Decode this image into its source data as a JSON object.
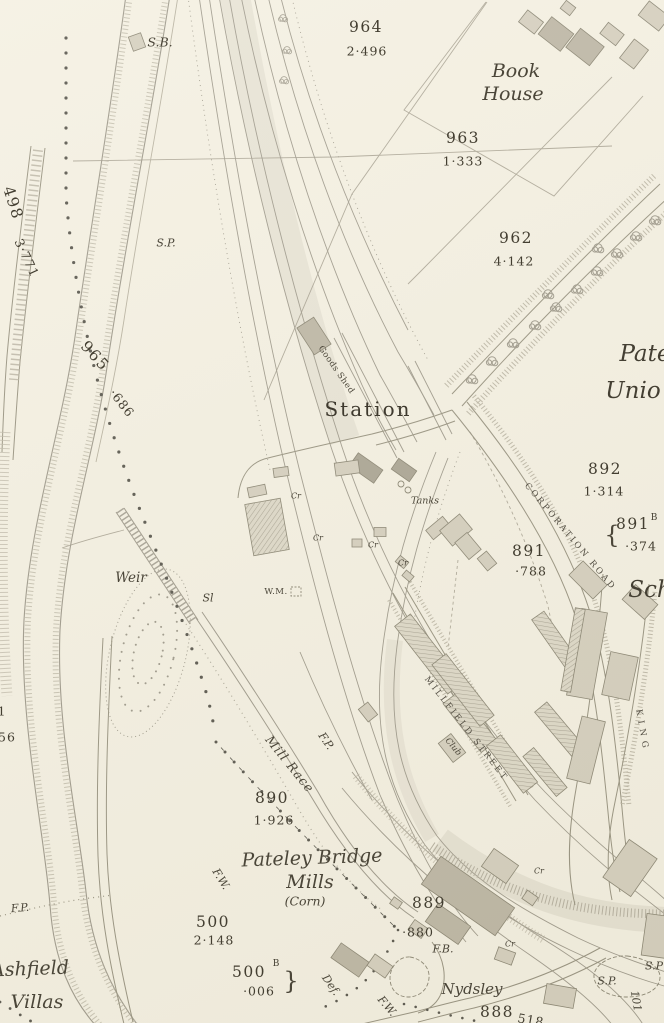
{
  "map": {
    "kind": "historical-survey-map",
    "labels": [
      {
        "n": "signal-box",
        "t": "S.B.",
        "x": 160,
        "y": 42,
        "r": 0,
        "c": "feat13"
      },
      {
        "n": "parcel-964",
        "t": "964",
        "x": 366,
        "y": 27,
        "r": 0,
        "c": "parcel"
      },
      {
        "n": "area-964",
        "t": "2·496",
        "x": 367,
        "y": 51,
        "r": 0,
        "c": "acre"
      },
      {
        "n": "book-house-line1",
        "t": "Book",
        "x": 516,
        "y": 71,
        "r": 0,
        "c": "place"
      },
      {
        "n": "book-house-line2",
        "t": "House",
        "x": 513,
        "y": 94,
        "r": 0,
        "c": "place"
      },
      {
        "n": "parcel-963",
        "t": "963",
        "x": 463,
        "y": 138,
        "r": 0,
        "c": "parcel"
      },
      {
        "n": "area-963",
        "t": "1·333",
        "x": 463,
        "y": 161,
        "r": 0,
        "c": "acre"
      },
      {
        "n": "parcel-962",
        "t": "962",
        "x": 516,
        "y": 238,
        "r": 0,
        "c": "parcel"
      },
      {
        "n": "area-962",
        "t": "4·142",
        "x": 514,
        "y": 261,
        "r": 0,
        "c": "acre"
      },
      {
        "n": "parcel-498",
        "t": "498",
        "x": 13,
        "y": 203,
        "r": 72,
        "c": "parcel"
      },
      {
        "n": "area-498",
        "t": "3·771",
        "x": 27,
        "y": 258,
        "r": 65,
        "c": "acre"
      },
      {
        "n": "signal-post-north",
        "t": "S.P.",
        "x": 166,
        "y": 243,
        "r": 0,
        "c": "feat"
      },
      {
        "n": "parcel-965",
        "t": "965",
        "x": 95,
        "y": 356,
        "r": 48,
        "c": "parcel"
      },
      {
        "n": "area-965",
        "t": "·686",
        "x": 122,
        "y": 403,
        "r": 52,
        "c": "acre"
      },
      {
        "n": "goods-shed",
        "t": "Goods Shed",
        "x": 336,
        "y": 370,
        "r": 55,
        "c": "tiny9"
      },
      {
        "n": "station",
        "t": "Station",
        "x": 368,
        "y": 409,
        "r": 0,
        "c": "station"
      },
      {
        "n": "pateley-union-line1",
        "t": "Pate",
        "x": 645,
        "y": 354,
        "r": 0,
        "c": "place-lg"
      },
      {
        "n": "pateley-union-line2",
        "t": "Unio",
        "x": 633,
        "y": 391,
        "r": 0,
        "c": "place-lg"
      },
      {
        "n": "parcel-892",
        "t": "892",
        "x": 605,
        "y": 469,
        "r": 0,
        "c": "parcel"
      },
      {
        "n": "area-892",
        "t": "1·314",
        "x": 604,
        "y": 491,
        "r": 0,
        "c": "acre"
      },
      {
        "n": "brace-891b",
        "t": "{",
        "x": 612,
        "y": 535,
        "r": 0,
        "c": "brace"
      },
      {
        "n": "parcel-891b",
        "t": "891",
        "x": 633,
        "y": 524,
        "r": 0,
        "c": "parcel"
      },
      {
        "n": "parcel-891b-sup",
        "t": "B",
        "x": 654,
        "y": 518,
        "r": 0,
        "c": "sup"
      },
      {
        "n": "area-891b",
        "t": "·374",
        "x": 641,
        "y": 546,
        "r": 0,
        "c": "acre"
      },
      {
        "n": "parcel-891",
        "t": "891",
        "x": 529,
        "y": 551,
        "r": 0,
        "c": "parcel"
      },
      {
        "n": "area-891",
        "t": "·788",
        "x": 531,
        "y": 571,
        "r": 0,
        "c": "acre"
      },
      {
        "n": "corporation-road",
        "t": "CORPORATION ROAD",
        "x": 570,
        "y": 537,
        "r": 50,
        "c": "road"
      },
      {
        "n": "weir",
        "t": "Weir",
        "x": 131,
        "y": 578,
        "r": 0,
        "c": "feat14"
      },
      {
        "n": "sluice",
        "t": "Sl",
        "x": 208,
        "y": 598,
        "r": 0,
        "c": "feat"
      },
      {
        "n": "weighing-machine",
        "t": "W.M.",
        "x": 276,
        "y": 592,
        "r": 0,
        "c": "tiny9"
      },
      {
        "n": "tanks",
        "t": "Tanks",
        "x": 425,
        "y": 501,
        "r": 0,
        "c": "feat10"
      },
      {
        "n": "crane-1",
        "t": "Cr",
        "x": 296,
        "y": 496,
        "r": 0,
        "c": "tiny8"
      },
      {
        "n": "crane-2",
        "t": "Cr",
        "x": 318,
        "y": 538,
        "r": 0,
        "c": "tiny8"
      },
      {
        "n": "crane-3",
        "t": "Cr",
        "x": 373,
        "y": 545,
        "r": 0,
        "c": "tiny8"
      },
      {
        "n": "crane-4",
        "t": "Cr",
        "x": 403,
        "y": 563,
        "r": 0,
        "c": "tiny8"
      },
      {
        "n": "crane-5",
        "t": "Cr",
        "x": 539,
        "y": 871,
        "r": 0,
        "c": "tiny8"
      },
      {
        "n": "crane-6",
        "t": "Cr",
        "x": 510,
        "y": 944,
        "r": 0,
        "c": "tiny8"
      },
      {
        "n": "millfield-street",
        "t": "MILLFIELD STREET",
        "x": 466,
        "y": 729,
        "r": 52,
        "c": "road"
      },
      {
        "n": "club",
        "t": "Club",
        "x": 453,
        "y": 747,
        "r": 50,
        "c": "tiny9i"
      },
      {
        "n": "footpath-millrace",
        "t": "F.P.",
        "x": 326,
        "y": 741,
        "r": 55,
        "c": "feat"
      },
      {
        "n": "mill-race",
        "t": "Mill Race",
        "x": 290,
        "y": 764,
        "r": 51,
        "c": "feat13",
        "ls": 1
      },
      {
        "n": "parcel-890",
        "t": "890",
        "x": 272,
        "y": 798,
        "r": 0,
        "c": "parcel"
      },
      {
        "n": "area-890",
        "t": "1·926",
        "x": 274,
        "y": 820,
        "r": 0,
        "c": "acre"
      },
      {
        "n": "fence-wall-1",
        "t": "F.W.",
        "x": 221,
        "y": 879,
        "r": 58,
        "c": "feat"
      },
      {
        "n": "mills-name-line1",
        "t": "Pateley Bridge",
        "x": 312,
        "y": 858,
        "r": -2,
        "c": "place"
      },
      {
        "n": "mills-name-line2",
        "t": "Mills",
        "x": 310,
        "y": 882,
        "r": 0,
        "c": "place"
      },
      {
        "n": "mills-name-line3",
        "t": "(Corn)",
        "x": 305,
        "y": 901,
        "r": 0,
        "c": "feat13"
      },
      {
        "n": "parcel-500",
        "t": "500",
        "x": 213,
        "y": 922,
        "r": 0,
        "c": "parcel"
      },
      {
        "n": "area-500",
        "t": "2·148",
        "x": 214,
        "y": 940,
        "r": 0,
        "c": "acre"
      },
      {
        "n": "parcel-889",
        "t": "889",
        "x": 429,
        "y": 903,
        "r": 0,
        "c": "parcel"
      },
      {
        "n": "area-889",
        "t": "·880",
        "x": 418,
        "y": 932,
        "r": 0,
        "c": "acre"
      },
      {
        "n": "foot-bridge",
        "t": "F.B.",
        "x": 443,
        "y": 949,
        "r": 0,
        "c": "feat"
      },
      {
        "n": "parcel-500b",
        "t": "500",
        "x": 249,
        "y": 972,
        "r": 0,
        "c": "parcel"
      },
      {
        "n": "parcel-500b-sup",
        "t": "B",
        "x": 276,
        "y": 964,
        "r": 0,
        "c": "sup"
      },
      {
        "n": "area-500b",
        "t": "·006",
        "x": 259,
        "y": 991,
        "r": 0,
        "c": "acre"
      },
      {
        "n": "brace-500b",
        "t": "}",
        "x": 291,
        "y": 981,
        "r": 0,
        "c": "brace"
      },
      {
        "n": "boundary-defaced",
        "t": "Def.",
        "x": 331,
        "y": 985,
        "r": 55,
        "c": "feat"
      },
      {
        "n": "fence-wall-2",
        "t": "F.W.",
        "x": 387,
        "y": 1006,
        "r": 50,
        "c": "feat"
      },
      {
        "n": "nydsley",
        "t": "Nydsley",
        "x": 472,
        "y": 989,
        "r": 0,
        "c": "place16"
      },
      {
        "n": "parcel-888",
        "t": "888",
        "x": 497,
        "y": 1012,
        "r": 0,
        "c": "parcel"
      },
      {
        "n": "parcel-518",
        "t": "518",
        "x": 531,
        "y": 1020,
        "r": 10,
        "c": "acre"
      },
      {
        "n": "signal-post-south1",
        "t": "S.P.",
        "x": 607,
        "y": 981,
        "r": 0,
        "c": "feat"
      },
      {
        "n": "signal-post-south2",
        "t": "S.P",
        "x": 654,
        "y": 966,
        "r": 0,
        "c": "feat"
      },
      {
        "n": "number-101",
        "t": "101",
        "x": 636,
        "y": 1001,
        "r": 80,
        "c": "feat"
      },
      {
        "n": "school",
        "t": "Sch",
        "x": 650,
        "y": 590,
        "r": 0,
        "c": "place-lg"
      },
      {
        "n": "king-street",
        "t": "KING",
        "x": 642,
        "y": 731,
        "r": 80,
        "c": "road",
        "ls": 5
      },
      {
        "n": "footpath-southwest",
        "t": "F.P.",
        "x": 20,
        "y": 908,
        "r": -5,
        "c": "feat"
      },
      {
        "n": "ashfield-villas-line1",
        "t": "Ashfield",
        "x": 30,
        "y": 969,
        "r": -2,
        "c": "place"
      },
      {
        "n": "ashfield-villas-line2",
        "t": "Villas",
        "x": 37,
        "y": 1002,
        "r": 0,
        "c": "place"
      },
      {
        "n": "edge-number-1",
        "t": "1",
        "x": 2,
        "y": 711,
        "r": 0,
        "c": "acre"
      },
      {
        "n": "edge-number-56",
        "t": "56",
        "x": 7,
        "y": 737,
        "r": 0,
        "c": "acre"
      }
    ]
  },
  "colors": {
    "paper": "#f4f0e2",
    "ink": "#4b4639",
    "line": "#8e897b",
    "faint": "#a59f90",
    "building_light": "#cfc9b8",
    "building_dark": "#b3ac9a",
    "hatch": "#9b9585"
  }
}
